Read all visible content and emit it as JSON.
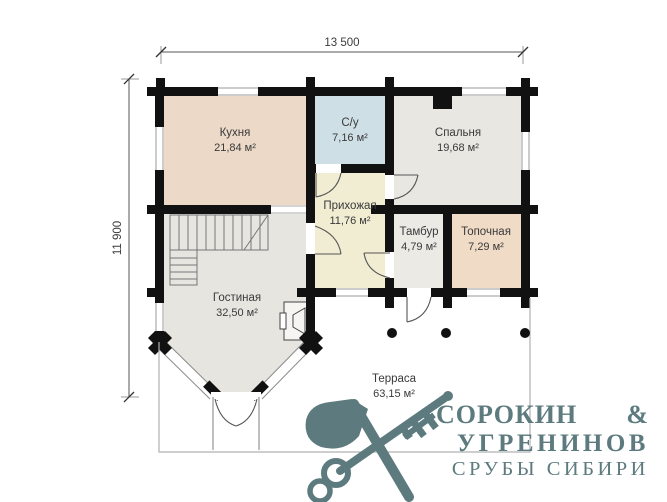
{
  "dimensions": {
    "width": "13 500",
    "height": "11 900"
  },
  "rooms": {
    "kitchen": {
      "name": "Кухня",
      "area": "21,84 м²",
      "color": "#ecd9c7"
    },
    "bathroom": {
      "name": "С/у",
      "area": "7,16 м²",
      "color": "#cfdfe6"
    },
    "bedroom": {
      "name": "Спальня",
      "area": "19,68 м²",
      "color": "#e9e7e2"
    },
    "hallway": {
      "name": "Прихожая",
      "area": "11,76 м²",
      "color": "#f0edd3"
    },
    "vestibule": {
      "name": "Тамбур",
      "area": "4,79 м²",
      "color": "#eceae5"
    },
    "boiler_room": {
      "name": "Топочная",
      "area": "7,29 м²",
      "color": "#f0dbc7"
    },
    "living_room": {
      "name": "Гостиная",
      "area": "32,50 м²",
      "color": "#e7e5e0"
    },
    "terrace": {
      "name": "Терраса",
      "area": "63,15 м²",
      "color": "#ffffff"
    }
  },
  "logo": {
    "partner1": "СОРОКИН",
    "ampersand": "&",
    "partner2": "УГРЕНИНОВ",
    "tagline": "СРУБЫ СИБИРИ",
    "color": "#5d7b7e"
  },
  "plan_colors": {
    "walls": "#111111",
    "dimension_lines": "#555555",
    "terrace_outline": "#b0b0b0"
  }
}
